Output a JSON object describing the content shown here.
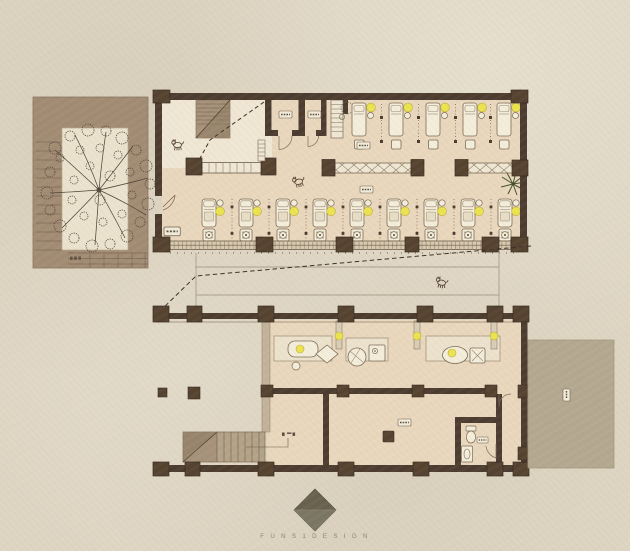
{
  "document": {
    "type": "architectural floor plan",
    "style": "hand-rendered tan site plan of a spa / bath house",
    "legible_text": "only the studio watermark is legible; room tags are sub-4px smudges"
  },
  "branding": {
    "logo_shape": "dark diamond",
    "wordmark": "F U N S 1 D E S I G N"
  },
  "palette": {
    "paper": "#ded5c2",
    "courtyard_paving": "#a28b73",
    "planter": "#ebe2cd",
    "interior_floor": "#e9d7bd",
    "lobby_floor": "#efe6d3",
    "terrace": "#b3a88f",
    "wall": "#4c3c30",
    "column": "#55422f",
    "wood_stair": "#a6927a",
    "sill": "#d7cab0",
    "fixture_white": "#f3edda",
    "lamp_yellow": "#ebe34e",
    "tree_line": "#4b4337",
    "plant_green": "#42512c",
    "dashed_guide": "#3b3126"
  },
  "site": {
    "courtyard": {
      "name": "entry courtyard",
      "features": [
        "large plan-view tree in planter",
        "side steps (west)",
        "lower steps (south)",
        "tiny step tag"
      ]
    },
    "upper_building": {
      "name": "treatment hall",
      "entry_lobby": [
        "staircase",
        "dashed sight line",
        "bench screen",
        "wall shoe rack",
        "door to courtyard",
        "cat"
      ],
      "small_rooms": 2,
      "storage_shelf": 1,
      "massage_beds_top_row": 5,
      "lounge_stations_bottom_row": 9,
      "cross_braced_tables": 2,
      "palm_plant": 1,
      "tag_boxes": 5
    },
    "driveway": {
      "name": "lane between buildings",
      "features": [
        "two edge lines",
        "long dashed guide line",
        "cat"
      ]
    },
    "lower_building": {
      "name": "bath house",
      "colonnade_columns": 7,
      "bath_partitions_with_lamps": 3,
      "bath_fixtures": [
        "lit soaking tub",
        "stool",
        "diamond basin",
        "round tub",
        "shower tray",
        "lit oval tub",
        "cross-marked tray"
      ],
      "inner_hall": [
        "service block",
        "tag box"
      ],
      "toilet_room": [
        "toilet",
        "wash basin",
        "tag box",
        "door"
      ],
      "exterior_stair_steps": 7,
      "porch_columns": 2
    },
    "terrace": {
      "name": "side terrace",
      "tag_boxes": 1
    },
    "animals": [
      "cat in lobby",
      "cat in hall",
      "cat on driveway"
    ]
  }
}
